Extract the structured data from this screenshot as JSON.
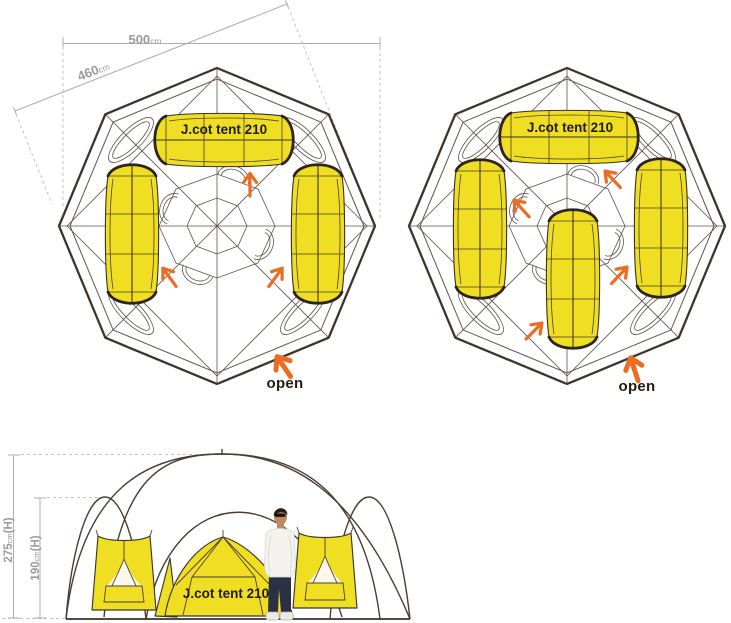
{
  "colors": {
    "tent_yellow": "#EFDE22",
    "arrow_orange": "#EC6C22",
    "frame_dark": "#3E342B",
    "dimension_gray": "#9B9B9B"
  },
  "top_view_left": {
    "width_label": {
      "value": "500",
      "unit": "cm"
    },
    "diagonal_label": {
      "value": "460",
      "unit": "cm"
    },
    "tent_label": "J.cot tent 210",
    "open_label": "open"
  },
  "top_view_right": {
    "tent_label": "J.cot tent 210",
    "open_label": "open"
  },
  "elevation": {
    "outer_height_label": {
      "value": "275",
      "unit": "cm",
      "suffix": "(H)"
    },
    "inner_height_label": {
      "value": "190",
      "unit": "cm",
      "suffix": "(H)"
    },
    "tent_label": "J.cot tent 210"
  }
}
